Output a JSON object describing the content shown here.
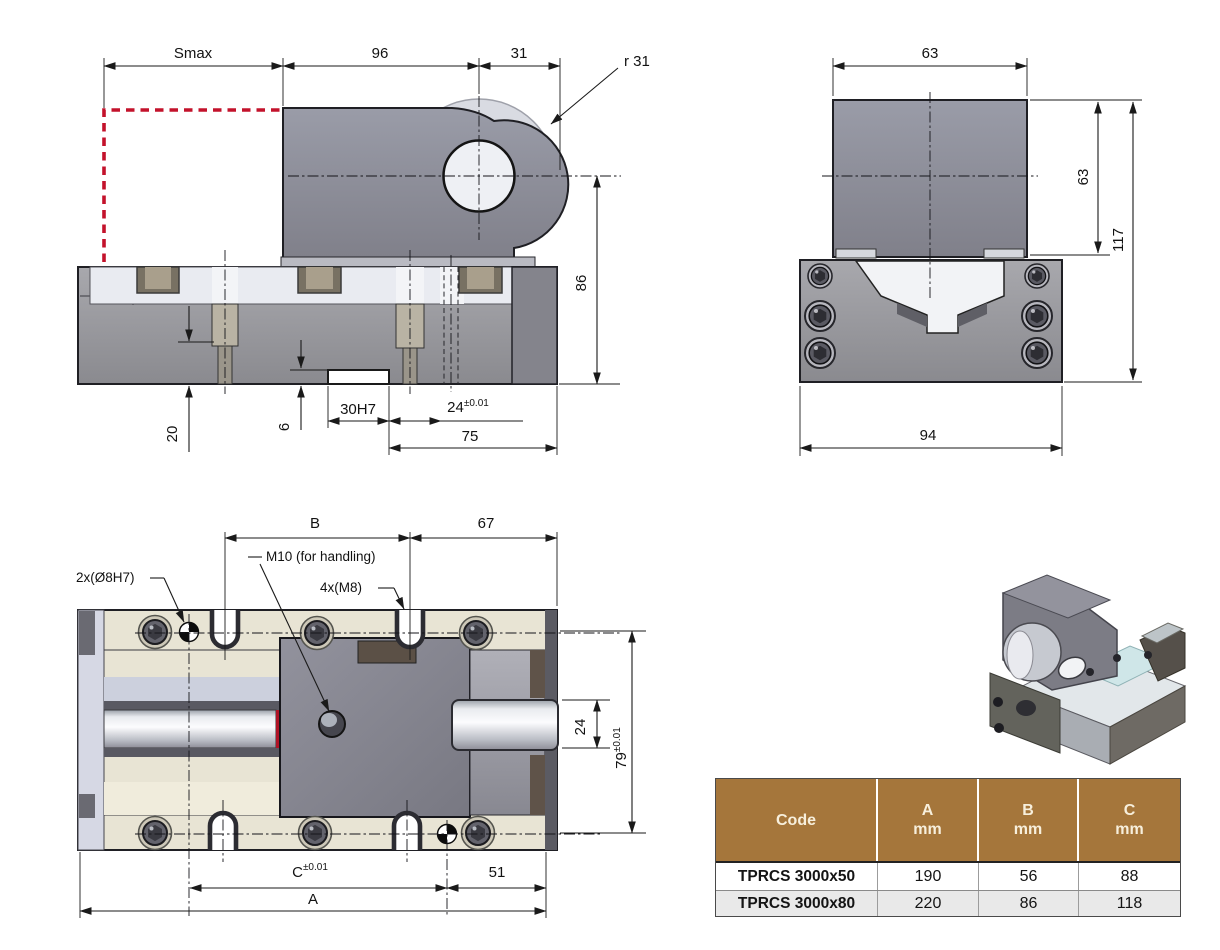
{
  "drawing": {
    "front": {
      "smax": "Smax",
      "w96": "96",
      "w31": "31",
      "r31": "r 31",
      "h86": "86",
      "d20": "20",
      "d6": "6",
      "slot": "30H7",
      "w24": "24",
      "w24_tol": "±0.01",
      "w75": "75"
    },
    "side": {
      "w63": "63",
      "h63": "63",
      "h117": "117",
      "w94": "94"
    },
    "top": {
      "b": "B",
      "w67": "67",
      "m10": "M10 (for handling)",
      "dowel": "2x(Ø8H7)",
      "m8": "4x(M8)",
      "h24": "24",
      "h79": "79",
      "h79_tol": "±0.01",
      "c": "C",
      "c_tol": "±0.01",
      "w51": "51",
      "a": "A"
    }
  },
  "table": {
    "col_code": "Code",
    "col_a": "A",
    "col_b": "B",
    "col_c": "C",
    "unit": "mm",
    "rows": [
      {
        "code": "TPRCS 3000x50",
        "a": "190",
        "b": "56",
        "c": "88"
      },
      {
        "code": "TPRCS 3000x80",
        "a": "220",
        "b": "86",
        "c": "118"
      }
    ]
  },
  "colors": {
    "accent_red": "#c3122b",
    "table_header": "#a5763b",
    "table_alt_row": "#e9e9e9",
    "metal_dark": "#84848c",
    "metal_light": "#e9ebf1",
    "line": "#1a1a1a"
  }
}
